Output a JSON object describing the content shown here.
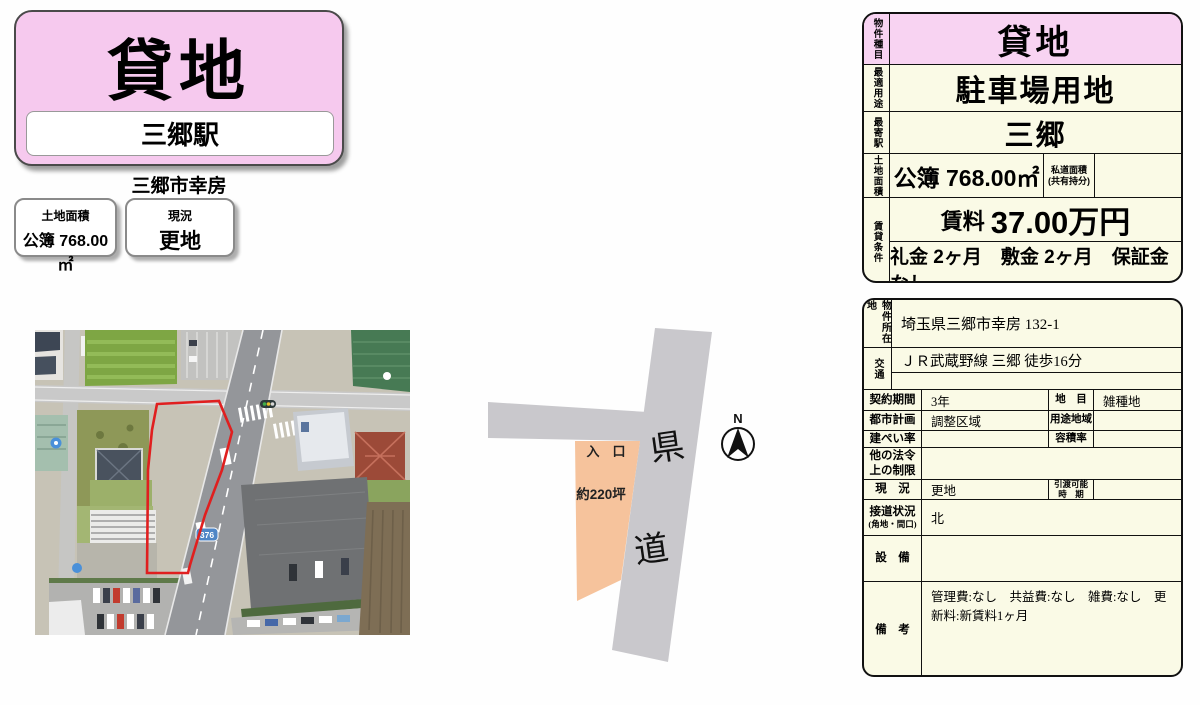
{
  "header": {
    "type_label": "貸地",
    "station": "三郷駅",
    "area_line": "三郷市幸房",
    "land_box": {
      "title": "土地面積",
      "value": "公簿 768.00㎡"
    },
    "status_box": {
      "title": "現況",
      "value": "更地"
    }
  },
  "map": {
    "route_shield": "376"
  },
  "diagram": {
    "entrance": "入　口",
    "lot_area": "約220坪",
    "road_char1": "県",
    "road_char2": "道",
    "north_label": "N"
  },
  "table1": {
    "r1": {
      "label": "物件種目",
      "value": "貸地"
    },
    "r2": {
      "label": "最適用途",
      "value": "駐車場用地"
    },
    "r3": {
      "label": "最寄駅",
      "value": "三郷"
    },
    "r4": {
      "label": "土地面積",
      "value": "公簿 768.00㎡",
      "sub_label1": "私道面積",
      "sub_label2": "(共有持分)",
      "sub_value": ""
    },
    "r5": {
      "label": "賃貸条件",
      "rent_prefix": "賃料",
      "rent_value": "37.00万円",
      "terms": "礼金 2ヶ月　敷金 2ヶ月　保証金 なし"
    }
  },
  "table2": {
    "address": {
      "label": "物件所在地",
      "value": "埼玉県三郷市幸房 132-1"
    },
    "access": {
      "label": "交通",
      "value": "ＪＲ武蔵野線 三郷 徒歩16分",
      "value2": ""
    },
    "contract": {
      "label": "契約期間",
      "value": "3年",
      "label2": "地　目",
      "value2": "雑種地"
    },
    "city_plan": {
      "label": "都市計画",
      "value": "調整区域",
      "label2": "用途地域",
      "value2": ""
    },
    "coverage": {
      "label": "建ぺい率",
      "value": "",
      "label2": "容積率",
      "value2": ""
    },
    "other_laws": {
      "label1": "他の法令",
      "label2": "上の制限",
      "value": ""
    },
    "status": {
      "label": "現　況",
      "value": "更地",
      "label2a": "引渡可能",
      "label2b": "時　期",
      "value2": ""
    },
    "frontage": {
      "label": "接道状況",
      "label_sub": "(角地・間口)",
      "value": "北"
    },
    "equipment": {
      "label": "設　備",
      "value": ""
    },
    "remarks": {
      "label": "備　考",
      "value": "管理費:なし　共益費:なし　雑費:なし　更新料:新賃料1ヶ月"
    }
  },
  "colors": {
    "header_pink": "#f6c9ee",
    "table_pink": "#f8d3f2",
    "table_cream": "#fafae6",
    "road_gray": "#c9c8cc",
    "lot_orange": "#f6c39c",
    "outline_red": "#e01f1f",
    "shield_blue": "#4f86c6"
  }
}
